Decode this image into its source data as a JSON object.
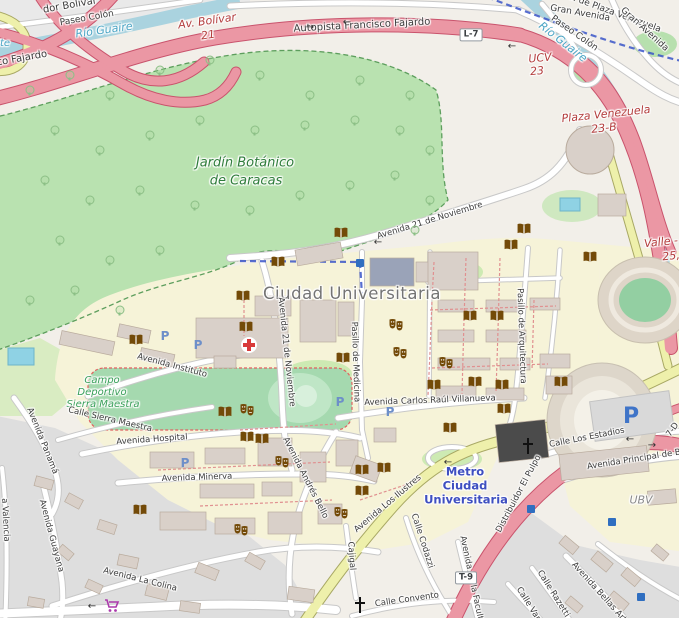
{
  "map_title": "Ciudad Universitaria de Caracas — OpenStreetMap style map",
  "theme": {
    "motorway": "#eb97a4",
    "motorway_casing": "#c9536c",
    "secondary_road": "#eef0ab",
    "minor_road": "#ffffff",
    "park": "#b9e2b0",
    "pitch": "#a5d9af",
    "water": "#aad3df",
    "campus": "#f6f3d8",
    "urban": "#dedede",
    "building": "#d9d0c9",
    "poi_brown": "#734a08",
    "metro_label_blue": "#3e4fc0",
    "ref_red": "#b33c3c",
    "park_label_green": "#2f7d3b",
    "water_label": "#49a4c4",
    "parking_blue": "#5f87c7",
    "shop_purple": "#ac39ac"
  },
  "place_labels": [
    {
      "t": "Jardín Botánico",
      "x": 245,
      "y": 163,
      "r": 0,
      "s": 13,
      "k": "parkname"
    },
    {
      "t": "de Caracas",
      "x": 246,
      "y": 181,
      "r": 0,
      "s": 13,
      "k": "parkname"
    },
    {
      "t": "Campo",
      "x": 102,
      "y": 381,
      "r": 0,
      "s": 10,
      "k": "pitchname"
    },
    {
      "t": "Deportivo",
      "x": 102,
      "y": 393,
      "r": 0,
      "s": 10,
      "k": "pitchname"
    },
    {
      "t": "Sierra Maestra",
      "x": 103,
      "y": 405,
      "r": 0,
      "s": 10,
      "k": "pitchname"
    },
    {
      "t": "Ciudad Universitaria",
      "x": 352,
      "y": 294,
      "r": 0,
      "s": 16.5,
      "k": "cityname"
    },
    {
      "t": "Metro",
      "x": 465,
      "y": 472,
      "r": 0,
      "s": 11.5,
      "k": "metroname"
    },
    {
      "t": "Ciudad",
      "x": 465,
      "y": 486,
      "r": 0,
      "s": 11.5,
      "k": "metroname"
    },
    {
      "t": "Universitaria",
      "x": 466,
      "y": 500,
      "r": 0,
      "s": 11.5,
      "k": "metroname"
    },
    {
      "t": "UBV",
      "x": 641,
      "y": 500,
      "r": 0,
      "s": 11,
      "k": "areaname"
    }
  ],
  "street_labels": [
    {
      "t": "Autopista Francisco Fajardo",
      "x": 362,
      "y": 26,
      "r": -3,
      "s": 10
    },
    {
      "t": "dor Bolívar",
      "x": 70,
      "y": 6,
      "r": -10,
      "s": 10
    },
    {
      "t": "Paseo Colón",
      "x": 87,
      "y": 19,
      "r": -10,
      "s": 9
    },
    {
      "t": "co Fajardo",
      "x": 22,
      "y": 59,
      "r": -10,
      "s": 10
    },
    {
      "t": "Av. de Plaza Venezuela",
      "x": 612,
      "y": 13,
      "r": 20,
      "s": 9
    },
    {
      "t": "Gran Avenida",
      "x": 580,
      "y": 14,
      "r": 10,
      "s": 9
    },
    {
      "t": "Gran Avenida",
      "x": 644,
      "y": 30,
      "r": 42,
      "s": 9
    },
    {
      "t": "Paseo Colón",
      "x": 574,
      "y": 34,
      "r": 35,
      "s": 9
    },
    {
      "t": "Avenida 21 de Noviembre",
      "x": 430,
      "y": 221,
      "r": -17,
      "s": 8.5
    },
    {
      "t": "Avenida 21 de Noviembre",
      "x": 286,
      "y": 352,
      "r": 84,
      "s": 8.5
    },
    {
      "t": "Pasillo de Medicina",
      "x": 355,
      "y": 362,
      "r": 88,
      "s": 8.5
    },
    {
      "t": "Pasillo de Arquitectura",
      "x": 521,
      "y": 336,
      "r": 88,
      "s": 8.5
    },
    {
      "t": "Avenida Instituto",
      "x": 172,
      "y": 366,
      "r": 15,
      "s": 8.5
    },
    {
      "t": "Calle Sierra Maestra",
      "x": 110,
      "y": 420,
      "r": 13,
      "s": 8.5
    },
    {
      "t": "Avenida Hospital",
      "x": 152,
      "y": 440,
      "r": -4,
      "s": 8.5
    },
    {
      "t": "Avenida Minerva",
      "x": 197,
      "y": 478,
      "r": -2,
      "s": 8.5
    },
    {
      "t": "Avenida Panamá",
      "x": 42,
      "y": 441,
      "r": 68,
      "s": 8.5
    },
    {
      "t": "Avenida Guayana",
      "x": 51,
      "y": 536,
      "r": 75,
      "s": 8.5
    },
    {
      "t": "a Valencia",
      "x": 5,
      "y": 520,
      "r": 87,
      "s": 8.5
    },
    {
      "t": "Avenida La Colina",
      "x": 140,
      "y": 580,
      "r": 14,
      "s": 8.5
    },
    {
      "t": "Avenida Andrés Bello",
      "x": 305,
      "y": 478,
      "r": 63,
      "s": 8.5
    },
    {
      "t": "Avenida Los Ilustres",
      "x": 388,
      "y": 504,
      "r": -40,
      "s": 8.5
    },
    {
      "t": "Avenida Carlos Raúl Villanueva",
      "x": 430,
      "y": 401,
      "r": -2,
      "s": 8.5
    },
    {
      "t": "Calle Los Estadios",
      "x": 587,
      "y": 438,
      "r": -11,
      "s": 8.5
    },
    {
      "t": "Avenida Principal de B",
      "x": 634,
      "y": 460,
      "r": -9,
      "s": 8.5
    },
    {
      "t": "Distribuidor El Pulpo",
      "x": 519,
      "y": 494,
      "r": -62,
      "s": 8.5
    },
    {
      "t": "Cajigal",
      "x": 351,
      "y": 556,
      "r": 86,
      "s": 8.5
    },
    {
      "t": "Calle Codazzi",
      "x": 422,
      "y": 541,
      "r": 72,
      "s": 8.5
    },
    {
      "t": "Calle Convento",
      "x": 407,
      "y": 600,
      "r": -8,
      "s": 8.5
    },
    {
      "t": "Avenida de la Facultad",
      "x": 472,
      "y": 583,
      "r": 78,
      "s": 8.5
    },
    {
      "t": "Calle Razetti",
      "x": 553,
      "y": 594,
      "r": 58,
      "s": 8.5
    },
    {
      "t": "Calle Var",
      "x": 528,
      "y": 604,
      "r": 58,
      "s": 8.5
    },
    {
      "t": "Avenida Bellas Artes",
      "x": 602,
      "y": 596,
      "r": 48,
      "s": 8.5
    },
    {
      "t": "7-D",
      "x": 673,
      "y": 430,
      "r": -55,
      "s": 8.5
    }
  ],
  "motorway_labels": [
    {
      "t": "Av. Bolívar",
      "x": 207,
      "y": 21,
      "r": -8,
      "s": 11
    },
    {
      "t": "21",
      "x": 208,
      "y": 35,
      "r": -8,
      "s": 11
    },
    {
      "t": "UCV",
      "x": 540,
      "y": 58,
      "r": -5,
      "s": 11
    },
    {
      "t": "23",
      "x": 537,
      "y": 71,
      "r": -5,
      "s": 11
    },
    {
      "t": "Plaza Venezuela",
      "x": 606,
      "y": 114,
      "r": -6,
      "s": 11
    },
    {
      "t": "23-B",
      "x": 604,
      "y": 128,
      "r": -6,
      "s": 11
    },
    {
      "t": "Valle -",
      "x": 661,
      "y": 242,
      "r": -6,
      "s": 11
    },
    {
      "t": "25,",
      "x": 671,
      "y": 256,
      "r": -6,
      "s": 11
    }
  ],
  "water_labels": [
    {
      "t": "Río Guaire",
      "x": 104,
      "y": 30,
      "r": -8,
      "s": 11
    },
    {
      "t": "Río Guaire",
      "x": 563,
      "y": 42,
      "r": 38,
      "s": 11
    },
    {
      "t": "te",
      "x": 5,
      "y": 44,
      "r": 0,
      "s": 10
    }
  ],
  "badges": [
    {
      "t": "L-7",
      "x": 471,
      "y": 35
    },
    {
      "t": "T-9",
      "x": 466,
      "y": 578
    }
  ],
  "icons": {
    "library": {
      "name": "library-book-icon",
      "points": [
        [
          341,
          233
        ],
        [
          524,
          229
        ],
        [
          511,
          245
        ],
        [
          590,
          257
        ],
        [
          278,
          262
        ],
        [
          243,
          296
        ],
        [
          246,
          327
        ],
        [
          136,
          340
        ],
        [
          470,
          316
        ],
        [
          497,
          316
        ],
        [
          343,
          358
        ],
        [
          434,
          385
        ],
        [
          475,
          382
        ],
        [
          502,
          385
        ],
        [
          561,
          382
        ],
        [
          504,
          409
        ],
        [
          225,
          412
        ],
        [
          450,
          428
        ],
        [
          247,
          437
        ],
        [
          262,
          439
        ],
        [
          362,
          470
        ],
        [
          384,
          468
        ],
        [
          362,
          491
        ],
        [
          140,
          510
        ]
      ]
    },
    "theatre": {
      "name": "theatre-masks-icon",
      "points": [
        [
          396,
          325
        ],
        [
          400,
          353
        ],
        [
          446,
          363
        ],
        [
          247,
          410
        ],
        [
          282,
          462
        ],
        [
          341,
          513
        ],
        [
          241,
          530
        ]
      ]
    },
    "parking": {
      "name": "parking-icon",
      "glyph": "P",
      "points": [
        [
          165,
          336
        ],
        [
          198,
          345
        ],
        [
          340,
          402
        ],
        [
          390,
          412
        ],
        [
          185,
          463
        ]
      ]
    },
    "parking_main": {
      "name": "parking-main-icon",
      "glyph": "P",
      "points": [
        [
          631,
          417
        ]
      ]
    },
    "hospital": {
      "name": "hospital-cross-icon",
      "points": [
        [
          249,
          345
        ]
      ]
    },
    "place_of_worship": {
      "name": "church-cross-icon",
      "points": [
        [
          528,
          446
        ],
        [
          360,
          605
        ]
      ]
    },
    "supermarket": {
      "name": "supermarket-cart-icon",
      "points": [
        [
          112,
          606
        ]
      ]
    },
    "metro_station": {
      "name": "metro-station-icon",
      "points": [
        [
          360,
          263
        ],
        [
          531,
          509
        ],
        [
          612,
          522
        ],
        [
          641,
          597
        ]
      ]
    }
  },
  "arrows": [
    {
      "g": "→",
      "x": 310,
      "y": 28
    },
    {
      "g": "←",
      "x": 347,
      "y": 23
    },
    {
      "g": "←",
      "x": 512,
      "y": 47
    },
    {
      "g": "←",
      "x": 378,
      "y": 243
    },
    {
      "g": "←",
      "x": 448,
      "y": 463
    },
    {
      "g": "←",
      "x": 630,
      "y": 440
    },
    {
      "g": "→",
      "x": 652,
      "y": 446
    },
    {
      "g": "←",
      "x": 92,
      "y": 607
    }
  ],
  "trees": [
    [
      30,
      90
    ],
    [
      70,
      75
    ],
    [
      110,
      95
    ],
    [
      160,
      70
    ],
    [
      210,
      60
    ],
    [
      260,
      75
    ],
    [
      310,
      95
    ],
    [
      360,
      80
    ],
    [
      410,
      95
    ],
    [
      55,
      130
    ],
    [
      100,
      150
    ],
    [
      150,
      135
    ],
    [
      200,
      120
    ],
    [
      255,
      130
    ],
    [
      305,
      125
    ],
    [
      355,
      120
    ],
    [
      400,
      130
    ],
    [
      430,
      150
    ],
    [
      45,
      180
    ],
    [
      90,
      200
    ],
    [
      140,
      190
    ],
    [
      195,
      205
    ],
    [
      250,
      210
    ],
    [
      300,
      195
    ],
    [
      350,
      185
    ],
    [
      395,
      175
    ],
    [
      60,
      240
    ],
    [
      110,
      260
    ],
    [
      160,
      250
    ],
    [
      30,
      300
    ],
    [
      75,
      290
    ],
    [
      120,
      310
    ],
    [
      430,
      200
    ],
    [
      415,
      230
    ]
  ]
}
